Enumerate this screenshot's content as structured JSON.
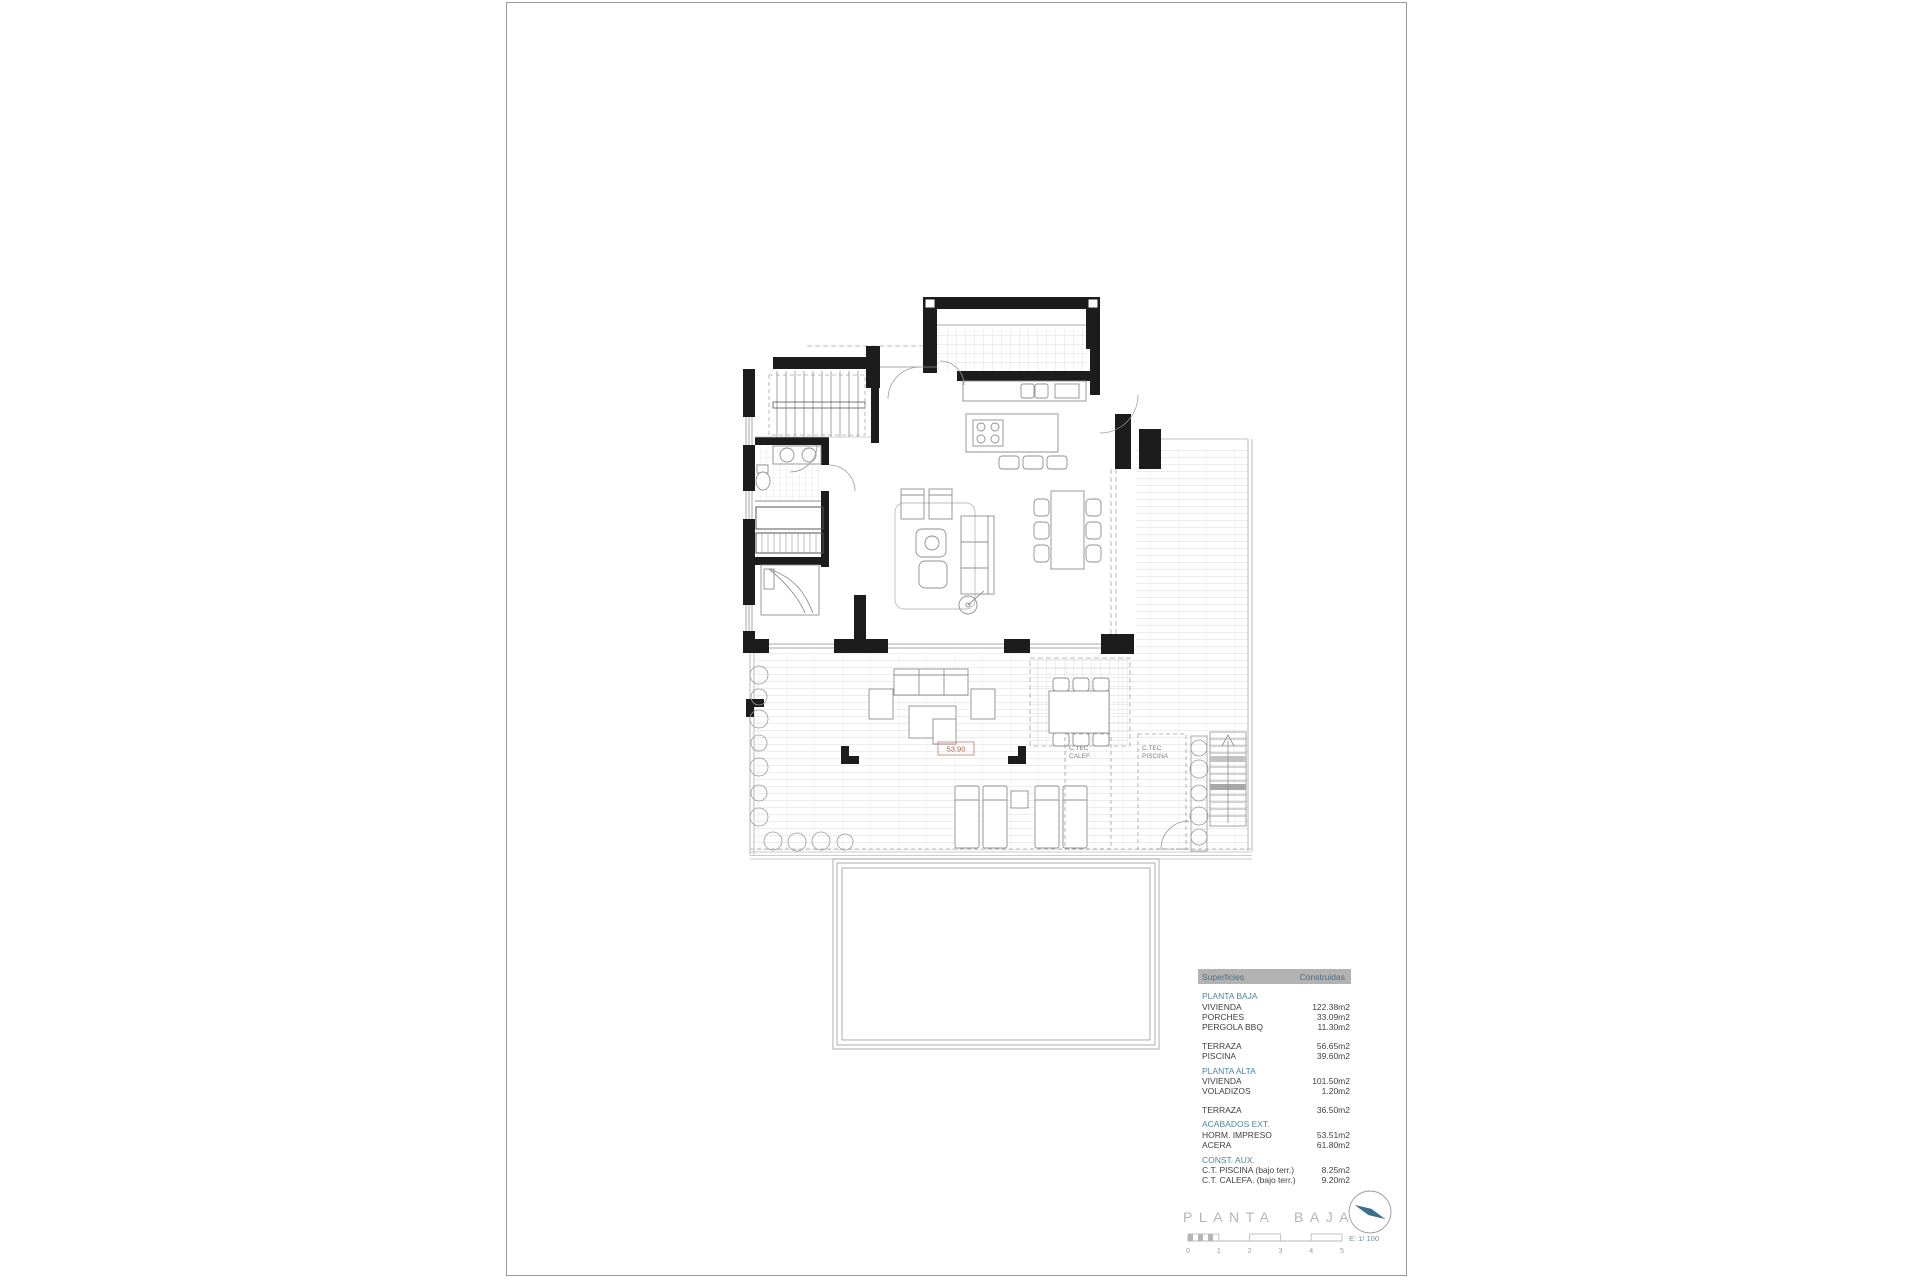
{
  "plan": {
    "labels": {
      "ct_calef_line1": "C.TEC",
      "ct_calef_line2": "CALEF.",
      "ct_piscina_line1": "C.TEC",
      "ct_piscina_line2": "PISCINA",
      "level_mark": "53.90"
    }
  },
  "areas_table": {
    "header": {
      "col1": "Superficies",
      "col2": "Construidas"
    },
    "rows": [
      {
        "type": "section",
        "label": "PLANTA BAJA",
        "value": ""
      },
      {
        "type": "item",
        "label": "VIVIENDA",
        "value": "122.38m2"
      },
      {
        "type": "item",
        "label": "PORCHES",
        "value": "33.09m2"
      },
      {
        "type": "item",
        "label": "PERGOLA BBQ",
        "value": "11.30m2"
      },
      {
        "type": "item",
        "label": "TERRAZA",
        "value": "56.65m2"
      },
      {
        "type": "item",
        "label": "PISCINA",
        "value": "39.60m2"
      },
      {
        "type": "section",
        "label": "PLANTA ALTA",
        "value": ""
      },
      {
        "type": "item",
        "label": "VIVIENDA",
        "value": "101.50m2"
      },
      {
        "type": "item",
        "label": "VOLADIZOS",
        "value": "1.20m2"
      },
      {
        "type": "item",
        "label": "TERRAZA",
        "value": "36.50m2"
      },
      {
        "type": "section",
        "label": "ACABADOS EXT.",
        "value": ""
      },
      {
        "type": "item",
        "label": "HORM. IMPRESO",
        "value": "53.51m2"
      },
      {
        "type": "item",
        "label": "ACERA",
        "value": "61.80m2"
      },
      {
        "type": "section",
        "label": "CONST. AUX.",
        "value": ""
      },
      {
        "type": "item",
        "label": "C.T. PISCINA (bajo terr.)",
        "value": "8.25m2"
      },
      {
        "type": "item",
        "label": "C.T. CALEFA. (bajo terr.)",
        "value": "9.20m2"
      }
    ]
  },
  "titlebar": {
    "title": "PLANTA BAJA",
    "scale_label": "E: 1/ 100",
    "scale_ticks": [
      "0",
      "1",
      "2",
      "3",
      "4",
      "5"
    ],
    "north_icon": "north-arrow"
  },
  "colors": {
    "wall": "#1c1c1c",
    "furniture": "#8f8f8f",
    "grid": "#d6d6d6",
    "table_header_bg": "#b2b2b2",
    "table_header_text": "#4c6e80",
    "section_text": "#4f85a0",
    "title_text": "#b5b5b5",
    "level_mark": "#b0614f",
    "north_needle": "#3c6e8e"
  }
}
